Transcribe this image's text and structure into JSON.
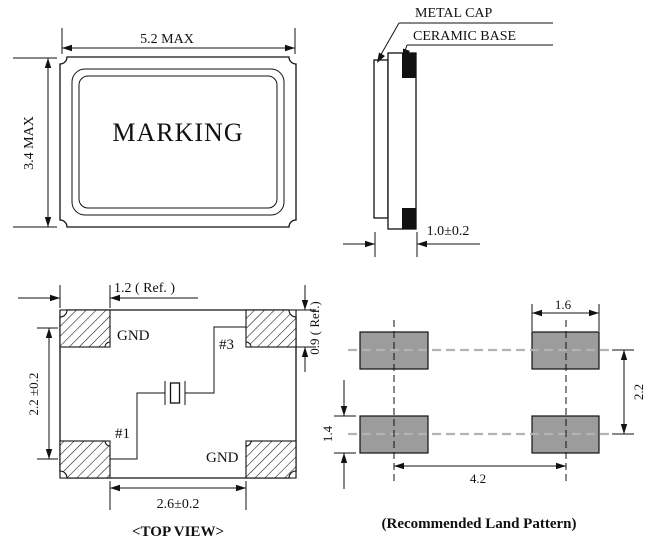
{
  "package_top_view": {
    "marking": "MARKING",
    "dim_width": "5.2 MAX",
    "dim_height": "3.4 MAX"
  },
  "side_view": {
    "label_metal_cap": "METAL CAP",
    "label_ceramic_base": "CERAMIC BASE",
    "dim_thickness": "1.0±0.2"
  },
  "top_view": {
    "caption": "<TOP VIEW>",
    "pad_labels": {
      "top_left": "GND",
      "top_right": "#3",
      "bottom_left": "#1",
      "bottom_right": "GND"
    },
    "dim_pad_width_ref": "1.2 ( Ref. )",
    "dim_pad_height_ref": "0.9 ( Ref.)",
    "dim_vertical_pitch": "2.2 ±0.2",
    "dim_horizontal_span": "2.6±0.2"
  },
  "land_pattern": {
    "caption": "(Recommended Land Pattern)",
    "dim_pad_width": "1.6",
    "dim_row_pitch": "2.2",
    "dim_pad_height": "1.4",
    "dim_column_pitch": "4.2"
  },
  "colors": {
    "line": "#111111",
    "pad_fill": "#9c9c9c",
    "centerline_gray": "#b3b3b3"
  }
}
